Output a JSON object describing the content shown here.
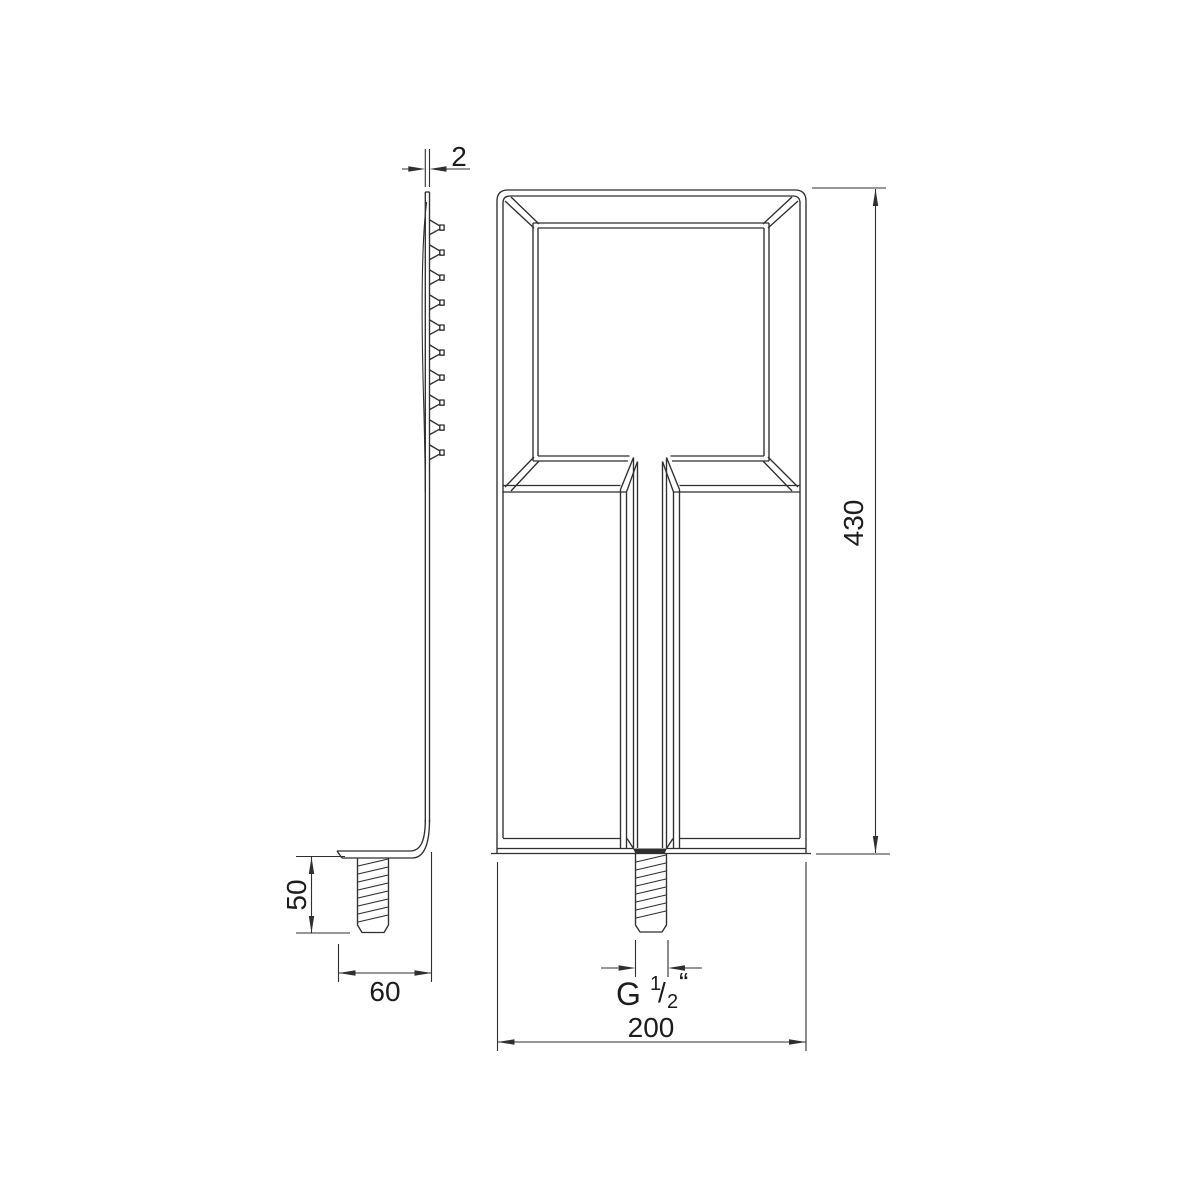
{
  "page": {
    "background": "#ffffff"
  },
  "drawing": {
    "line_color": "#2f2f2f",
    "text_color": "#1c1c1c",
    "labels": {
      "plate_thickness": "2",
      "overall_height": "430",
      "stud_length": "50",
      "flange_width": "60",
      "overall_width": "200",
      "thread": {
        "prefix": "G",
        "numerator": "1",
        "slash": "/",
        "denominator": "2",
        "inch_mark": "“"
      }
    }
  }
}
